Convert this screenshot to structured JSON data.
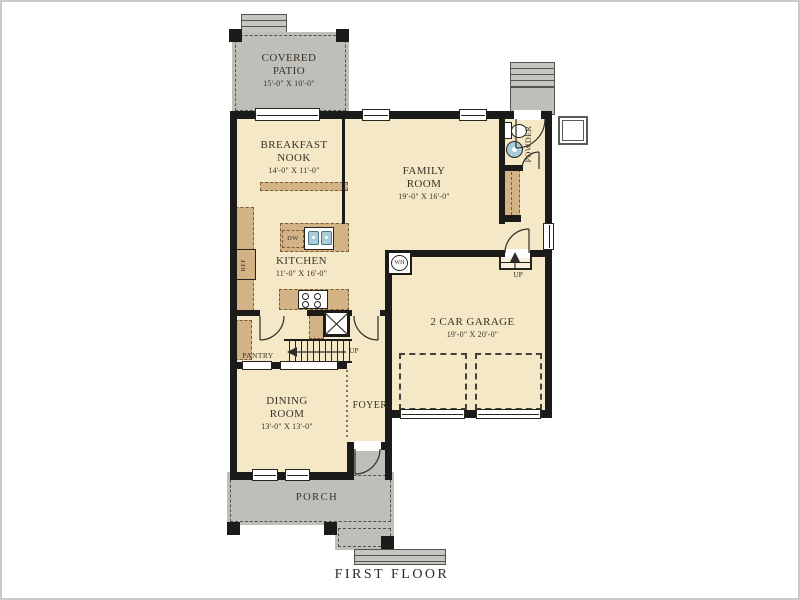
{
  "title": "FIRST FLOOR",
  "colors": {
    "floor_fill": "#F5E8C6",
    "outdoor_fill": "#BFBFB9",
    "cabinet_fill": "#D3B285",
    "wall": "#1B1B19",
    "text": "#3A3127",
    "fixture_blue": "#A9CCD8"
  },
  "rooms": {
    "covered_patio": {
      "line1": "COVERED",
      "line2": "PATIO",
      "dims": "15'-0\" X 10'-0\""
    },
    "breakfast_nook": {
      "line1": "BREAKFAST",
      "line2": "NOOK",
      "dims": "14'-0\" X 11'-0\""
    },
    "family_room": {
      "line1": "FAMILY",
      "line2": "ROOM",
      "dims": "19'-0\" X 16'-0\""
    },
    "kitchen": {
      "line1": "KITCHEN",
      "dims": "11'-0\" X 16'-0\""
    },
    "garage": {
      "line1": "2 CAR GARAGE",
      "dims": "19'-0\" X 20'-0\""
    },
    "dining_room": {
      "line1": "DINING",
      "line2": "ROOM",
      "dims": "13'-0\" X 13'-0\""
    },
    "foyer": {
      "label": "FOYER"
    },
    "pantry": {
      "label": "PANTRY"
    },
    "porch": {
      "label": "PORCH"
    },
    "powder": {
      "label": "POWDER"
    }
  },
  "annotations": {
    "up_stairs": "UP",
    "up_garage": "UP"
  },
  "fixtures": {
    "dishwasher": "DW",
    "refrigerator": "REF",
    "water_heater": "WH"
  }
}
